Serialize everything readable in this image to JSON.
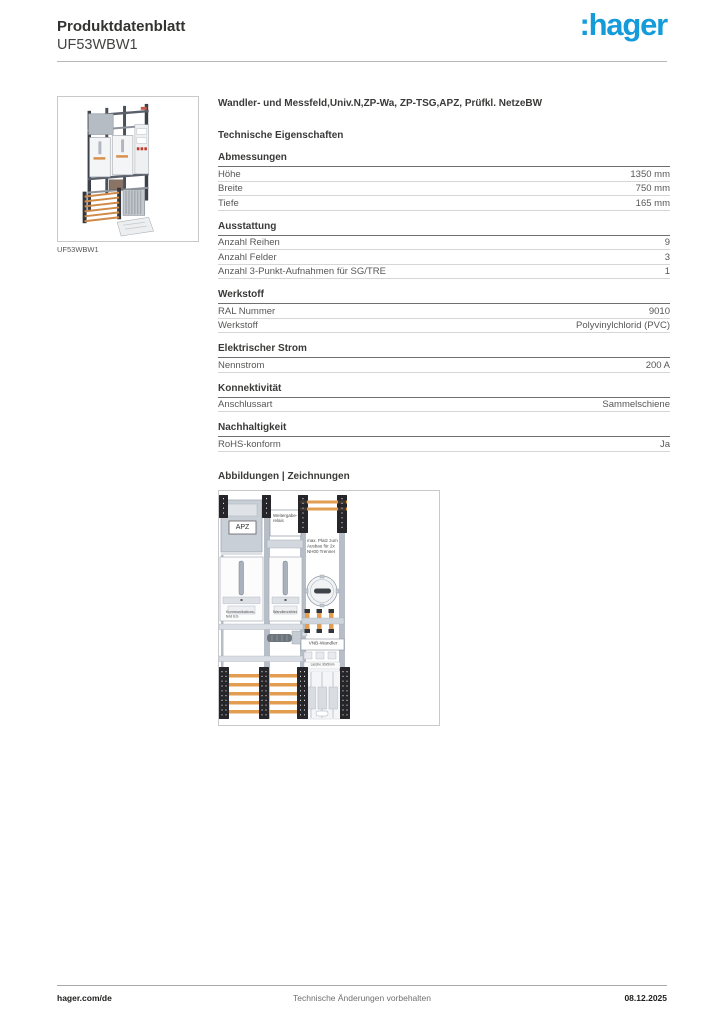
{
  "header": {
    "doc_type": "Produktdatenblatt",
    "product_ref": "UF53WBW1",
    "logo_text": ":hager"
  },
  "brand_color": "#149bd9",
  "thumbnail": {
    "caption": "UF53WBW1"
  },
  "content": {
    "product_title": "Wandler- und Messfeld,Univ.N,ZP-Wa, ZP-TSG,APZ, Prüfkl. NetzeBW",
    "tech_section_title": "Technische Eigenschaften",
    "drawings_section_title": "Abbildungen | Zeichnungen",
    "groups": [
      {
        "title": "Abmessungen",
        "rows": [
          {
            "label": "Höhe",
            "value": "1350 mm"
          },
          {
            "label": "Breite",
            "value": "750 mm"
          },
          {
            "label": "Tiefe",
            "value": "165 mm"
          }
        ]
      },
      {
        "title": "Ausstattung",
        "rows": [
          {
            "label": "Anzahl Reihen",
            "value": "9"
          },
          {
            "label": "Anzahl Felder",
            "value": "3"
          },
          {
            "label": "Anzahl 3-Punkt-Aufnahmen für SG/TRE",
            "value": "1"
          }
        ]
      },
      {
        "title": "Werkstoff",
        "rows": [
          {
            "label": "RAL Nummer",
            "value": "9010"
          },
          {
            "label": "Werkstoff",
            "value": "Polyvinylchlorid (PVC)"
          }
        ]
      },
      {
        "title": "Elektrischer Strom",
        "rows": [
          {
            "label": "Nennstrom",
            "value": "200 A"
          }
        ]
      },
      {
        "title": "Konnektivität",
        "rows": [
          {
            "label": "Anschlussart",
            "value": "Sammelschiene"
          }
        ]
      },
      {
        "title": "Nachhaltigkeit",
        "rows": [
          {
            "label": "RoHS-konform",
            "value": "Ja"
          }
        ]
      }
    ]
  },
  "drawing": {
    "labels": {
      "apz": "APZ",
      "relay": "Weitergabe-relais",
      "max_space": "max. Platz zum Ausbau für 2x NH00 Trenner",
      "field_left": "Kommunikations-feld EG",
      "field_mid": "Wandlerzähler",
      "vnb": "VNB-Wandler",
      "lasche": "Lasche 30x5mm"
    }
  },
  "footer": {
    "left": "hager.com/de",
    "center": "Technische Änderungen vorbehalten",
    "right": "08.12.2025"
  }
}
